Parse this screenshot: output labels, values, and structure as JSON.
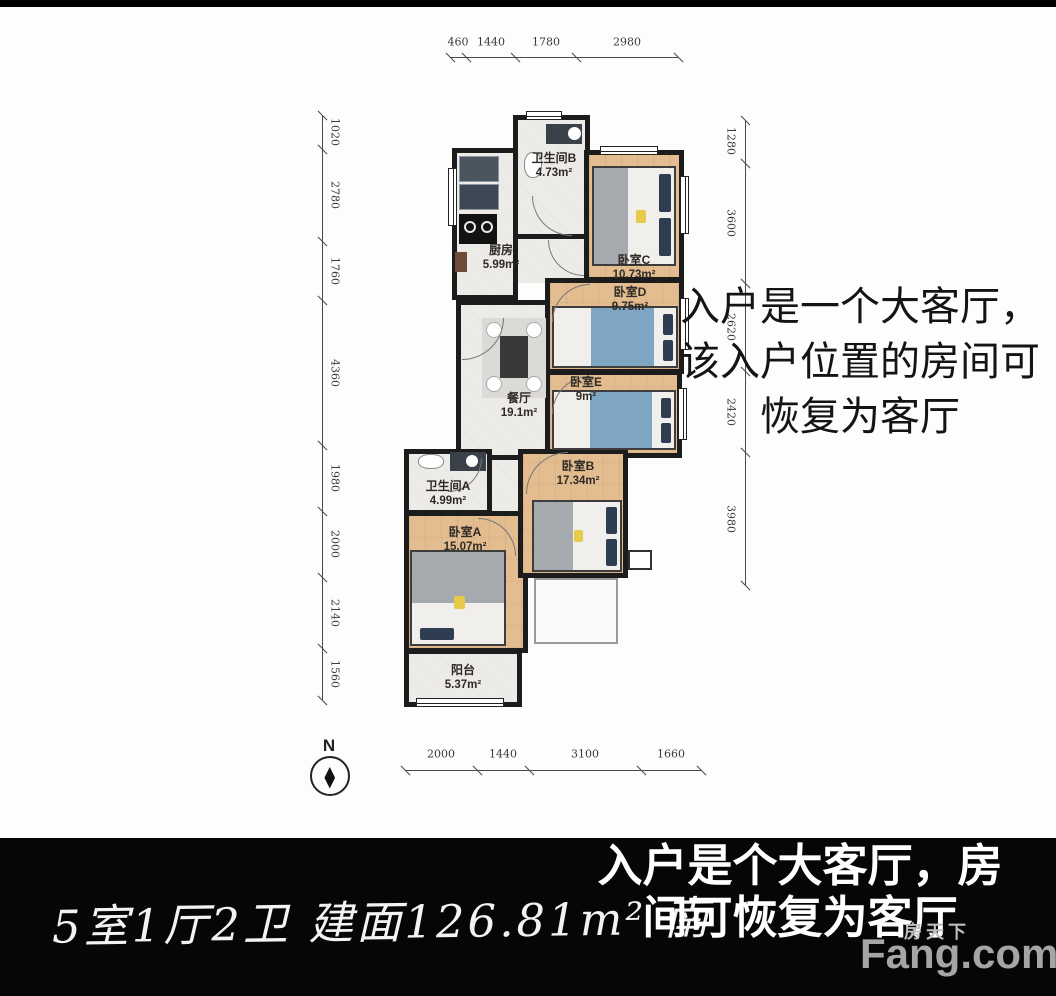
{
  "dimensions": {
    "top": [
      "460",
      "1440",
      "1780",
      "2980"
    ],
    "bottom": [
      "2000",
      "1440",
      "3100",
      "1660"
    ],
    "left": [
      "1020",
      "2780",
      "1760",
      "4360",
      "1980",
      "2000",
      "2140",
      "1560"
    ],
    "right": [
      "1280",
      "3600",
      "2620",
      "2420",
      "3980"
    ]
  },
  "compass": {
    "north_label": "N"
  },
  "rooms": [
    {
      "name": "卫生间B",
      "area": "4.73m²"
    },
    {
      "name": "厨房",
      "area": "5.99m²"
    },
    {
      "name": "卧室C",
      "area": "10.73m²"
    },
    {
      "name": "卧室D",
      "area": "9.75m²"
    },
    {
      "name": "卧室E",
      "area": "9m²"
    },
    {
      "name": "餐厅",
      "area": "19.1m²"
    },
    {
      "name": "卫生间A",
      "area": "4.99m²"
    },
    {
      "name": "卧室B",
      "area": "17.34m²"
    },
    {
      "name": "卧室A",
      "area": "15.07m²"
    },
    {
      "name": "阳台",
      "area": "5.37m²"
    }
  ],
  "side_note": {
    "lines": [
      "入户是一个大客厅，",
      "该入户位置的房间可",
      "恢复为客厅"
    ]
  },
  "footer": {
    "summary": "5室1厅2卫 建面126.81m² 南",
    "note_lines": [
      "入户是个大客厅，房",
      "间可恢复为客厅"
    ]
  },
  "logo": {
    "cn": "房天下",
    "en": "Fang.com"
  },
  "colors": {
    "wall": "#1c1c1c",
    "wood_floor": "#e3bd90",
    "tile_floor": "#edebe8",
    "footer_bg": "#060606",
    "pillow_navy": "#2f3d53",
    "blanket_gray": "#a6a9ad",
    "blanket_blue": "#7ea6c2",
    "accent_yellow": "#e7c94c",
    "logo_gray": "#a5a5a5"
  }
}
